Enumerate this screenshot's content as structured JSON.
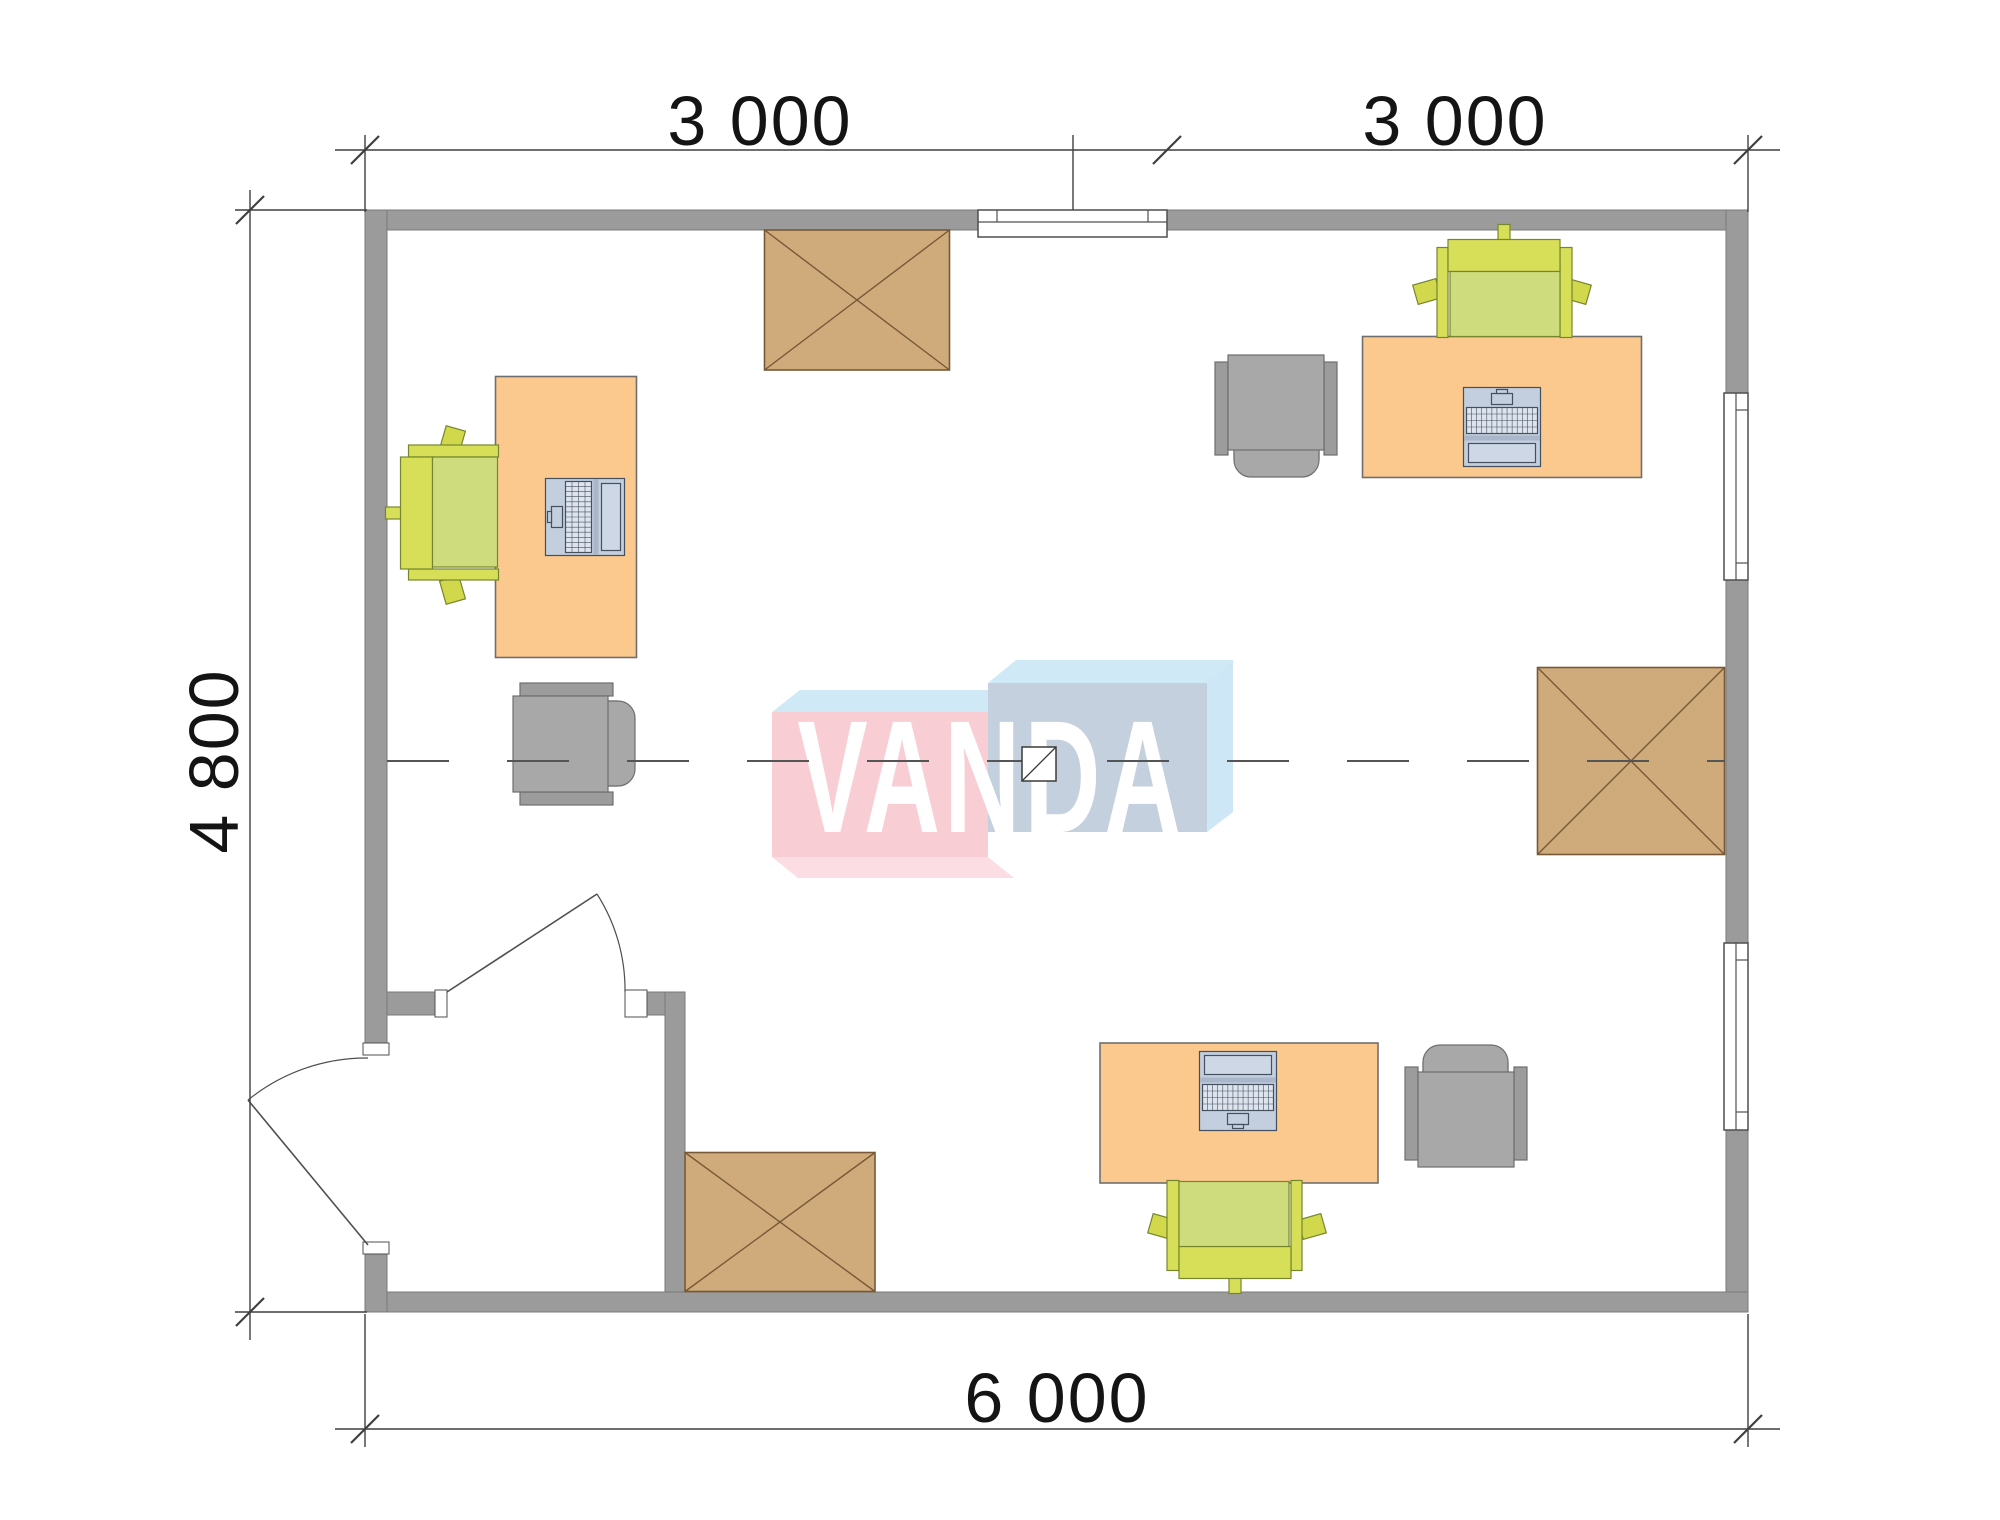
{
  "watermark": {
    "text": "VANDA"
  },
  "dimensions": {
    "top_left": "3 000",
    "top_right": "3 000",
    "left": "4 800",
    "bottom": "6 000"
  },
  "colors": {
    "background": "#ffffff",
    "wall_fill": "#9b9b9b",
    "wall_stroke": "#7a7a7a",
    "line": "#3f3f3f",
    "text": "#141414",
    "desk_fill": "#fbc88d",
    "desk_stroke": "#6f6f6f",
    "chair_dark": "#d7df58",
    "chair_seat": "#cfdc7e",
    "chair_arm": "#d2d84b",
    "chair_stroke": "#76862e",
    "gray_fill": "#a8a8a8",
    "gray_arm": "#9c9c9c",
    "gray_stroke": "#6e6e6e",
    "laptop_body": "#c3cedf",
    "laptop_screen": "#cdd7e5",
    "laptop_key": "#dde4ee",
    "laptop_hinge": "#aab6c9",
    "laptop_stroke": "#45505f",
    "cabinet_fill": "#cfab7c",
    "cabinet_stroke": "#775937",
    "window_fill": "#ffffff",
    "window_stroke": "#4f4f4f",
    "door_stroke": "#4f4f4f",
    "centerline": "#555555",
    "logo_pink": "#f8cdd4",
    "logo_pink_bottom": "#fbdde3",
    "logo_blue_front": "#c5d0de",
    "logo_top": "#cfe9f7",
    "logo_right": "#cde7f6",
    "logo_text_color": "#ffffff"
  },
  "plan": {
    "canvas": [
      2000,
      1520
    ],
    "walls": [
      {
        "name": "wall-top-left",
        "rect": [
          365,
          210,
          613,
          20
        ]
      },
      {
        "name": "wall-top-right",
        "rect": [
          1167,
          210,
          581,
          20
        ]
      },
      {
        "name": "wall-right-upper",
        "rect": [
          1726,
          210,
          22,
          183
        ]
      },
      {
        "name": "wall-right-middle",
        "rect": [
          1726,
          580,
          22,
          363
        ]
      },
      {
        "name": "wall-right-lower",
        "rect": [
          1726,
          1130,
          22,
          182
        ]
      },
      {
        "name": "wall-bottom",
        "rect": [
          365,
          1292,
          1383,
          20
        ]
      },
      {
        "name": "wall-left-upper",
        "rect": [
          365,
          210,
          22,
          845
        ]
      },
      {
        "name": "wall-left-lower",
        "rect": [
          365,
          1242,
          22,
          70
        ]
      },
      {
        "name": "wall-vestibule-left-stub",
        "rect": [
          387,
          992,
          48,
          23
        ]
      },
      {
        "name": "wall-vestibule-right-stub",
        "rect": [
          647,
          992,
          38,
          23
        ]
      },
      {
        "name": "wall-vestibule-right",
        "rect": [
          665,
          992,
          20,
          300
        ]
      }
    ],
    "windows": [
      {
        "name": "window-top",
        "orient": "h",
        "rect": [
          978,
          210,
          189,
          27
        ],
        "mid": 222,
        "jambs": [
          997,
          1148
        ]
      },
      {
        "name": "window-right-upper",
        "orient": "v",
        "rect": [
          1724,
          393,
          24,
          187
        ],
        "mid": 1736,
        "jambs": [
          410,
          563
        ]
      },
      {
        "name": "window-right-lower",
        "orient": "v",
        "rect": [
          1724,
          943,
          24,
          187
        ],
        "mid": 1736,
        "jambs": [
          960,
          1112
        ]
      }
    ],
    "doors": [
      {
        "name": "door-interior",
        "jambs": [
          [
            435,
            990,
            12,
            27
          ],
          [
            625,
            990,
            22,
            27
          ]
        ],
        "leaf": [
          447,
          992,
          597,
          894
        ],
        "arc": {
          "from": [
            597,
            894
          ],
          "to": [
            625,
            992
          ],
          "r": 178,
          "sweep": 1
        }
      },
      {
        "name": "door-entrance",
        "jambs": [
          [
            363,
            1043,
            26,
            12
          ],
          [
            363,
            1242,
            26,
            12
          ]
        ],
        "leaf": [
          368,
          1245,
          248,
          1100
        ],
        "arc": {
          "from": [
            248,
            1100
          ],
          "to": [
            368,
            1058
          ],
          "r": 188,
          "sweep": 1
        }
      }
    ],
    "furniture": [
      {
        "name": "desk-1",
        "type": "desk",
        "cx": 566,
        "cy": 517,
        "w": 141,
        "h": 281,
        "rot": 0
      },
      {
        "name": "task-chair-1",
        "type": "chair",
        "cx": 442,
        "cy": 515,
        "rot": -90
      },
      {
        "name": "laptop-1",
        "type": "laptop",
        "cx": 585,
        "cy": 517,
        "rot": 90
      },
      {
        "name": "visitor-chair-1",
        "type": "armchair",
        "cx": 573,
        "cy": 744,
        "rot": -90
      },
      {
        "name": "cabinet-1",
        "type": "cabinet",
        "cx": 857,
        "cy": 300,
        "w": 185,
        "h": 140
      },
      {
        "name": "desk-2",
        "type": "desk",
        "cx": 1502,
        "cy": 407,
        "w": 279,
        "h": 141,
        "rot": 0
      },
      {
        "name": "task-chair-2",
        "type": "chair",
        "cx": 1502,
        "cy": 281,
        "rot": 0
      },
      {
        "name": "laptop-2",
        "type": "laptop",
        "cx": 1502,
        "cy": 427,
        "rot": 180
      },
      {
        "name": "visitor-chair-2",
        "type": "armchair",
        "cx": 1276,
        "cy": 415,
        "rot": 0
      },
      {
        "name": "desk-3",
        "type": "desk",
        "cx": 1239,
        "cy": 1113,
        "w": 278,
        "h": 140,
        "rot": 0
      },
      {
        "name": "task-chair-3",
        "type": "chair",
        "cx": 1237,
        "cy": 1237,
        "rot": 180
      },
      {
        "name": "laptop-3",
        "type": "laptop",
        "cx": 1238,
        "cy": 1091,
        "rot": 0
      },
      {
        "name": "visitor-chair-3",
        "type": "armchair",
        "cx": 1466,
        "cy": 1107,
        "rot": 180
      },
      {
        "name": "cabinet-2",
        "type": "cabinet",
        "cx": 780,
        "cy": 1222,
        "w": 190,
        "h": 139
      },
      {
        "name": "cabinet-3",
        "type": "cabinet",
        "cx": 1631,
        "cy": 761,
        "w": 187,
        "h": 187
      }
    ],
    "center_line": {
      "y": 761,
      "x1": 387,
      "x2": 1725,
      "dash": [
        62,
        58
      ]
    },
    "center_marker": {
      "rect": [
        1022,
        747,
        34,
        34
      ]
    },
    "logo": {
      "pink_bottom": [
        [
          772,
          857
        ],
        [
          988,
          857
        ],
        [
          1014,
          878
        ],
        [
          798,
          878
        ]
      ],
      "pink_top": [
        [
          772,
          712
        ],
        [
          800,
          690
        ],
        [
          1016,
          690
        ],
        [
          988,
          712
        ]
      ],
      "pink_front": [
        772,
        712,
        216,
        145
      ],
      "blue_top": [
        [
          988,
          683
        ],
        [
          1016,
          660
        ],
        [
          1233,
          660
        ],
        [
          1207,
          683
        ]
      ],
      "blue_right": [
        [
          1207,
          683
        ],
        [
          1233,
          660
        ],
        [
          1233,
          812
        ],
        [
          1207,
          832
        ]
      ],
      "blue_front": [
        988,
        683,
        219,
        149
      ]
    },
    "dimension_lines": [
      [
        335,
        150,
        1780,
        150
      ],
      [
        365,
        135,
        365,
        212
      ],
      [
        1073,
        135,
        1073,
        210
      ],
      [
        1748,
        135,
        1748,
        212
      ],
      [
        250,
        190,
        250,
        1340
      ],
      [
        235,
        210,
        367,
        210
      ],
      [
        235,
        1312,
        367,
        1312
      ],
      [
        335,
        1429,
        1780,
        1429
      ],
      [
        365,
        1314,
        365,
        1447
      ],
      [
        1748,
        1314,
        1748,
        1447
      ]
    ],
    "dimension_ticks": [
      [
        365,
        150
      ],
      [
        1167,
        150
      ],
      [
        1748,
        150
      ],
      [
        250,
        210
      ],
      [
        250,
        1312
      ],
      [
        365,
        1429
      ],
      [
        1748,
        1429
      ]
    ]
  }
}
